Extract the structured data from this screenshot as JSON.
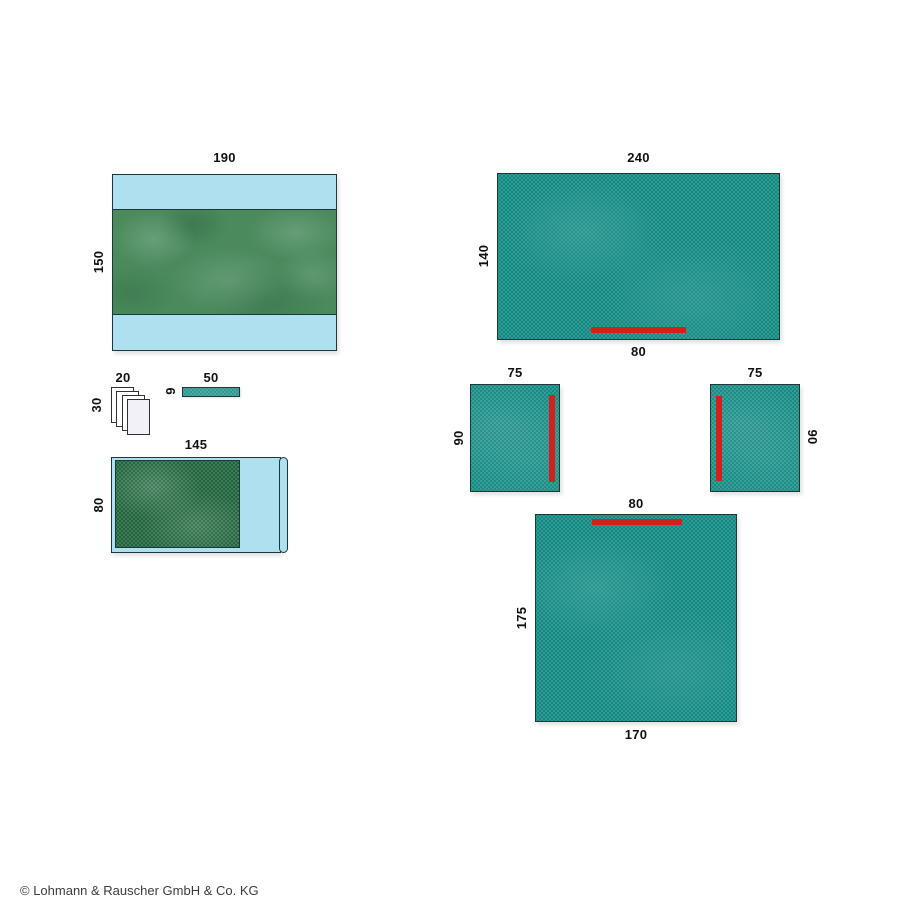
{
  "items": {
    "wrap_drape": {
      "width_label": "190",
      "height_label": "150"
    },
    "swab_stack": {
      "width_label": "20",
      "height_label": "30"
    },
    "tape_strip": {
      "width_label": "50",
      "height_label": "9"
    },
    "table_cover": {
      "width_label": "145",
      "height_label": "80"
    },
    "large_drape": {
      "width_label": "240",
      "height_label": "140",
      "adhesive_label": "80"
    },
    "side_drape_left": {
      "width_label": "75",
      "height_label": "90"
    },
    "side_drape_right": {
      "width_label": "75",
      "height_label": "90"
    },
    "bottom_drape": {
      "adhesive_label": "80",
      "height_label": "175",
      "width_label": "170"
    }
  },
  "footer": {
    "copyright": "© Lohmann & Rauscher GmbH & Co. KG"
  },
  "colors": {
    "teal": "#2aa39a",
    "teal-dot": "#1a837c",
    "green": "#4a8a5c",
    "green-dot-base": "#3e8657",
    "green-dot": "#255c3f",
    "light-blue": "#aee0f0",
    "red": "#d51f1f",
    "outline": "#1d3838",
    "sheet": "#ffffff",
    "sheet-front": "#f1f1f7",
    "sheet-outline": "#30303a",
    "text": "#111111",
    "copy-text": "#3c3c3c"
  }
}
